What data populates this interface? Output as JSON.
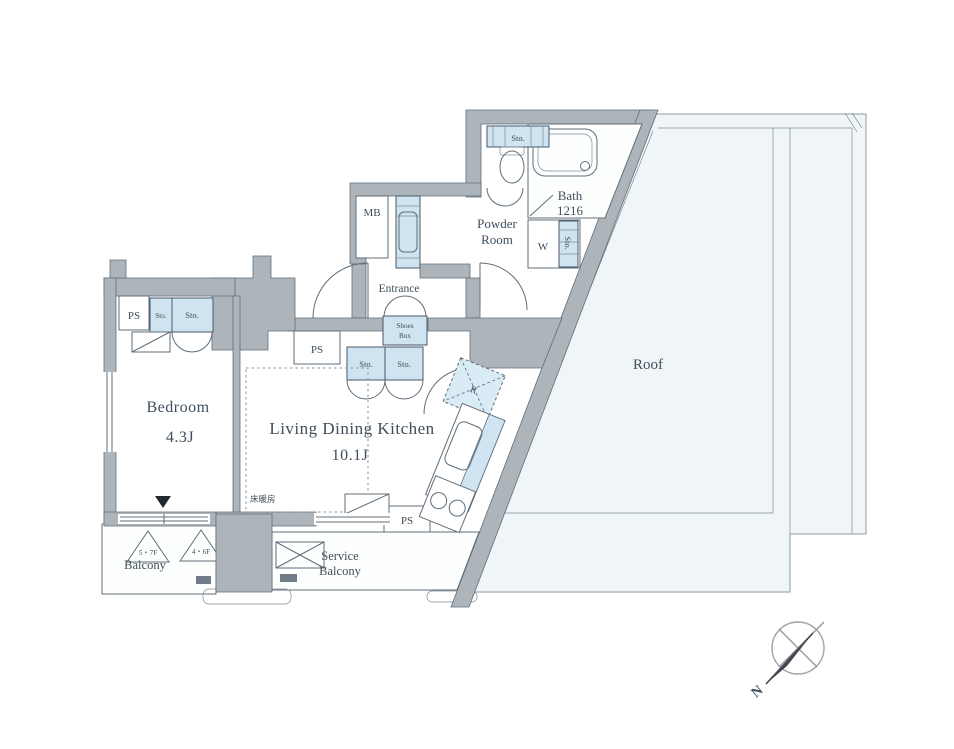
{
  "plan": {
    "bedroom": {
      "label": "Bedroom",
      "area": "4.3J"
    },
    "ldk": {
      "label": "Living Dining Kitchen",
      "area": "10.1J"
    },
    "bath": {
      "label": "Bath",
      "size": "1216"
    },
    "powder_room": {
      "line1": "Powder",
      "line2": "Room"
    },
    "entrance": {
      "label": "Entrance"
    },
    "roof": {
      "label": "Roof"
    },
    "balcony": {
      "label": "Balcony",
      "hatch_upper": "5・7F",
      "hatch_lower": "4・6F"
    },
    "service_balcony": {
      "line1": "Service",
      "line2": "Balcony"
    },
    "shoes_box": {
      "line1": "Shoes",
      "line2": "Box"
    },
    "labels": {
      "mb": "MB",
      "ps": "PS",
      "sto": "Sto.",
      "w": "W",
      "r": "R",
      "floor_heating": "床暖房",
      "north": "N"
    }
  },
  "colors": {
    "wall_gray": "#adb4ba",
    "storage_blue": "#cfe4f0",
    "line": "#5f6e7a",
    "roof_fill": "#f0f6f8",
    "text": "#3f4e5a"
  }
}
